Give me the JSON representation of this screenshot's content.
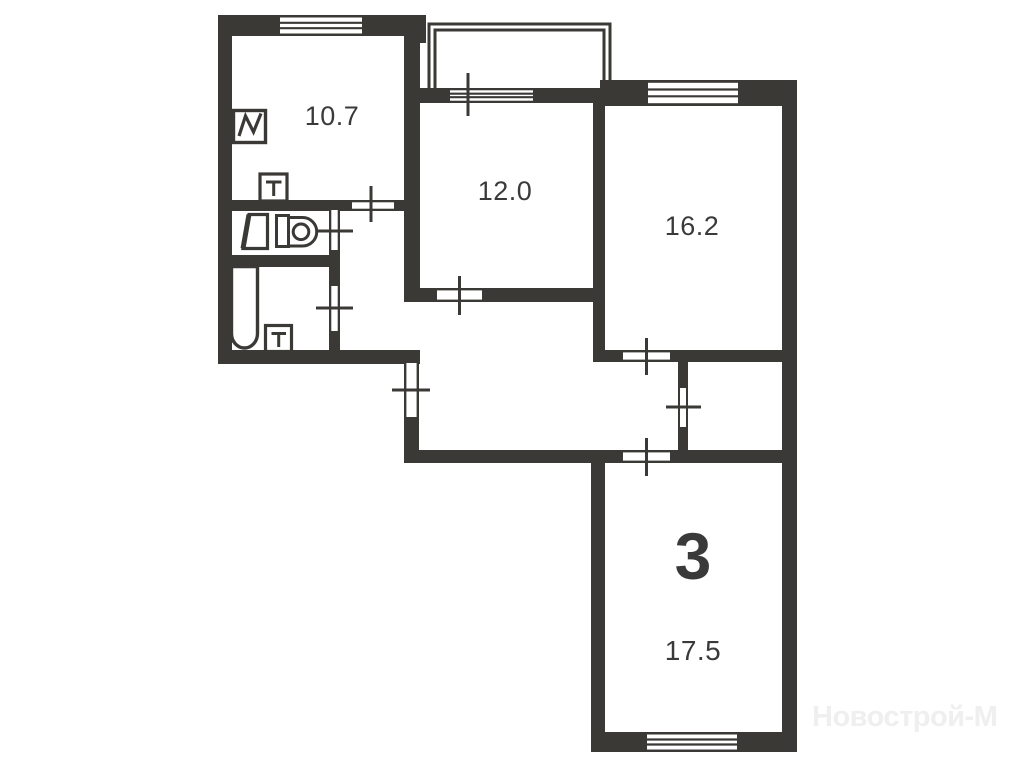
{
  "plan": {
    "type": "apartment-floor-plan",
    "apartment_number": "3",
    "rooms": [
      {
        "name": "kitchen",
        "area": "10.7"
      },
      {
        "name": "bedroom-1",
        "area": "12.0"
      },
      {
        "name": "bedroom-2",
        "area": "16.2"
      },
      {
        "name": "living-room",
        "area": "17.5"
      }
    ],
    "watermark": "Новострой-М",
    "colors": {
      "wall": "#3b3936",
      "label_text": "#3a3a3a",
      "background": "#ffffff",
      "watermark": "#efefef"
    },
    "fixtures": [
      "stove-icon",
      "kitchen-sink-icon",
      "wc-washbasin-icon",
      "toilet-icon",
      "bathtub-icon",
      "bathroom-sink-icon"
    ]
  }
}
